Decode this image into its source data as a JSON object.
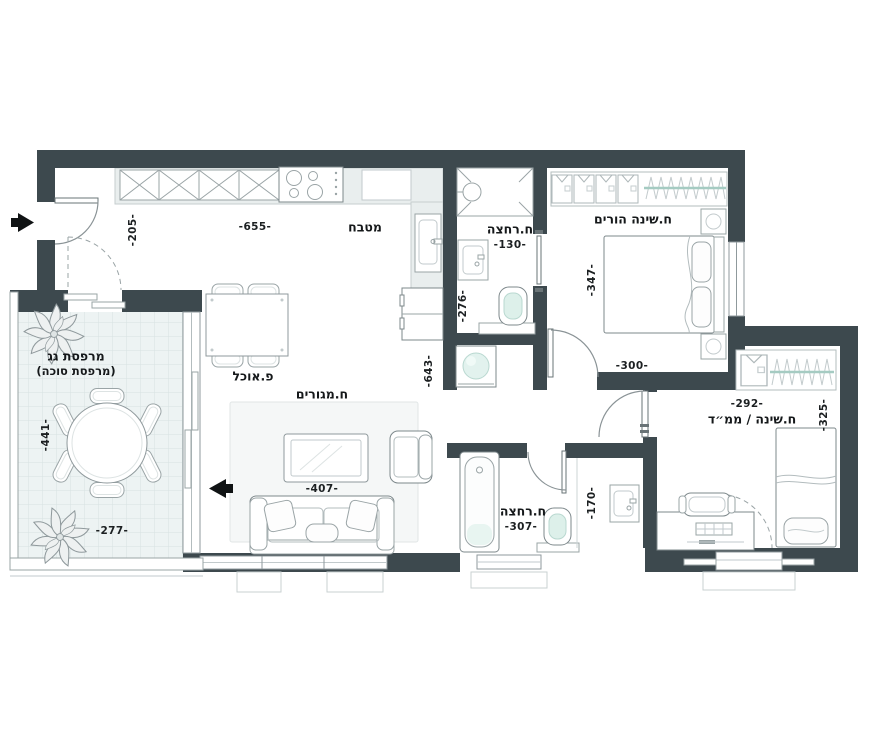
{
  "colors": {
    "wall": "#3d494e",
    "mint_accent": "#ddf0ea",
    "closet_rod": "#a5cbc2"
  },
  "rooms": {
    "kitchen": {
      "label": "מטבח",
      "dim_width": "-655-",
      "dim_entry": "-205-"
    },
    "bathroom_top": {
      "label": "ח.רחצה",
      "dim_width": "-130-",
      "dim_length": "-276-"
    },
    "master_bedroom": {
      "label": "ח.שינה הורים",
      "dim_length": "-347-",
      "dim_width": "-300-"
    },
    "corridor": {
      "dim_length": "-643-"
    },
    "living_room": {
      "label": "ח.מגורים",
      "dim_width": "-407-"
    },
    "dining": {
      "label": "פ.אוכל"
    },
    "balcony": {
      "label": "מרפסת גג",
      "sublabel": "(מרפסת סוכה)",
      "dim_length": "-441-",
      "dim_width": "-277-"
    },
    "bathroom_bottom": {
      "label": "ח.רחצה",
      "dim_width": "-307-",
      "dim_length": "-170-"
    },
    "bedroom2": {
      "label": "ח.שינה / ממ״ד",
      "dim_width": "-292-",
      "dim_length": "-325-"
    }
  }
}
